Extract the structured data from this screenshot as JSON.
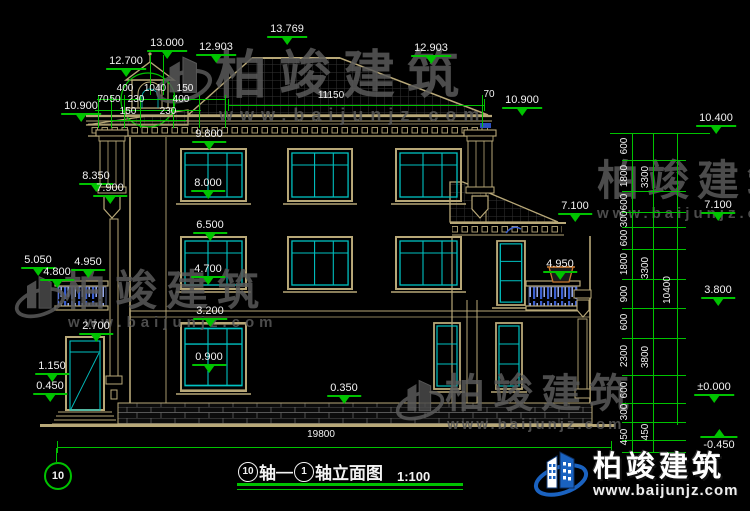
{
  "meta": {
    "drawing_type": "building elevation (CAD)"
  },
  "colors": {
    "background": "#000000",
    "dimension_green": "#00c300",
    "outline_tan": "#b8a878",
    "window_cyan": "#00c2c2",
    "text_white": "#f2f2f2",
    "baluster_blue": "#3a5fd0",
    "watermark_gray": "#5a5a5a",
    "logo_blue": "#1a62c0"
  },
  "watermark": {
    "brand": "柏竣建筑",
    "url": "www.baijunjz.com"
  },
  "brand_logo": {
    "brand": "柏竣建筑",
    "url": "www.baijunjz.com"
  },
  "axis_bubble": {
    "label": "10"
  },
  "title_block": {
    "axis_start": "10",
    "axis_text_1": "轴",
    "dash": "—",
    "axis_end": "1",
    "axis_text_2": "轴立面图",
    "scale": "1:100",
    "full_title": "⑩轴—①轴立面图 1:100"
  },
  "annotations": {
    "elevation_markers": [
      {
        "t": "13.769",
        "x": 287,
        "y": 23
      },
      {
        "t": "13.000",
        "x": 167,
        "y": 37
      },
      {
        "t": "12.700",
        "x": 126,
        "y": 55
      },
      {
        "t": "12.903",
        "x": 216,
        "y": 41
      },
      {
        "t": "12.903",
        "x": 431,
        "y": 42
      },
      {
        "t": "10.900",
        "x": 81,
        "y": 100
      },
      {
        "t": "10.900",
        "x": 522,
        "y": 94
      },
      {
        "t": "10.400",
        "x": 716,
        "y": 112
      },
      {
        "t": "9.800",
        "x": 209,
        "y": 128
      },
      {
        "t": "8.000",
        "x": 208,
        "y": 177
      },
      {
        "t": "6.500",
        "x": 210,
        "y": 219
      },
      {
        "t": "4.700",
        "x": 208,
        "y": 263
      },
      {
        "t": "3.200",
        "x": 210,
        "y": 305
      },
      {
        "t": "0.900",
        "x": 209,
        "y": 351
      },
      {
        "t": "0.350",
        "x": 344,
        "y": 382
      },
      {
        "t": "8.350",
        "x": 96,
        "y": 170
      },
      {
        "t": "7.900",
        "x": 110,
        "y": 182
      },
      {
        "t": "5.050",
        "x": 38,
        "y": 254
      },
      {
        "t": "4.950",
        "x": 88,
        "y": 256
      },
      {
        "t": "4.800",
        "x": 57,
        "y": 266
      },
      {
        "t": "2.700",
        "x": 96,
        "y": 320
      },
      {
        "t": "1.150",
        "x": 52,
        "y": 360
      },
      {
        "t": "0.450",
        "x": 50,
        "y": 380
      },
      {
        "t": "7.100",
        "x": 575,
        "y": 200
      },
      {
        "t": "4.950",
        "x": 560,
        "y": 258
      },
      {
        "t": "7.100",
        "x": 718,
        "y": 199
      },
      {
        "t": "3.800",
        "x": 718,
        "y": 284
      },
      {
        "t": "±0.000",
        "x": 714,
        "y": 381
      },
      {
        "t": "-0.450",
        "x": 719,
        "y": 429,
        "flip": true
      }
    ],
    "dim_labels": [
      {
        "t": "400",
        "x": 125,
        "y": 84
      },
      {
        "t": "1040",
        "x": 155,
        "y": 84
      },
      {
        "t": "150",
        "x": 185,
        "y": 84
      },
      {
        "t": "70",
        "x": 103,
        "y": 95
      },
      {
        "t": "50",
        "x": 115,
        "y": 95
      },
      {
        "t": "230",
        "x": 136,
        "y": 95
      },
      {
        "t": "400",
        "x": 181,
        "y": 95
      },
      {
        "t": "150",
        "x": 128,
        "y": 107
      },
      {
        "t": "230",
        "x": 168,
        "y": 107
      },
      {
        "t": "11150",
        "x": 331,
        "y": 91
      },
      {
        "t": "70",
        "x": 489,
        "y": 90
      },
      {
        "t": "19800",
        "x": 321,
        "y": 430
      }
    ],
    "rotated_labels": [
      {
        "t": "600",
        "x": 625,
        "y": 146
      },
      {
        "t": "1800",
        "x": 625,
        "y": 176
      },
      {
        "t": "600",
        "x": 625,
        "y": 202
      },
      {
        "t": "300",
        "x": 625,
        "y": 219
      },
      {
        "t": "600",
        "x": 625,
        "y": 238
      },
      {
        "t": "1800",
        "x": 625,
        "y": 264
      },
      {
        "t": "900",
        "x": 625,
        "y": 294
      },
      {
        "t": "600",
        "x": 625,
        "y": 322
      },
      {
        "t": "2300",
        "x": 625,
        "y": 356
      },
      {
        "t": "600",
        "x": 625,
        "y": 390
      },
      {
        "t": "300",
        "x": 625,
        "y": 412
      },
      {
        "t": "450",
        "x": 625,
        "y": 437
      },
      {
        "t": "3300",
        "x": 646,
        "y": 177
      },
      {
        "t": "3300",
        "x": 646,
        "y": 268
      },
      {
        "t": "3800",
        "x": 646,
        "y": 357
      },
      {
        "t": "450",
        "x": 646,
        "y": 432
      },
      {
        "t": "10400",
        "x": 668,
        "y": 290
      }
    ]
  }
}
